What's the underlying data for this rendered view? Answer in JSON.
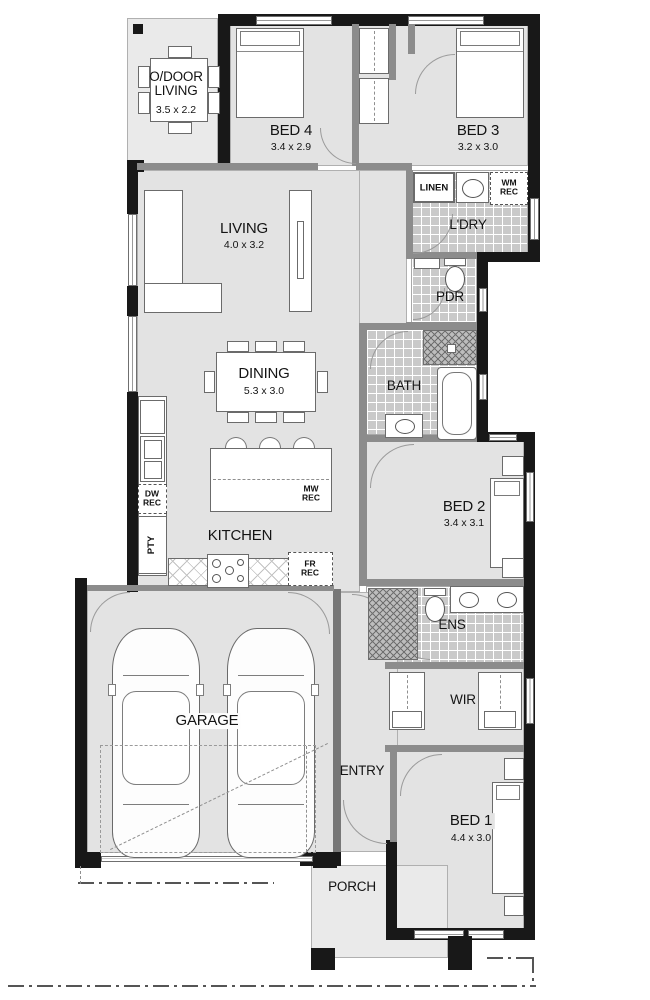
{
  "plan_title": "floor-plan",
  "colors": {
    "wall": "#181818",
    "floor": "#e3e3e3",
    "tile": "#c9c9c9",
    "ink": "#141414"
  },
  "rooms": {
    "odoor": {
      "line1": "O/DOOR",
      "line2": "LIVING",
      "dims": "3.5 x 2.2"
    },
    "bed4": {
      "name": "BED 4",
      "dims": "3.4 x 2.9"
    },
    "bed3": {
      "name": "BED 3",
      "dims": "3.2 x 3.0"
    },
    "linen": {
      "name": "LINEN"
    },
    "wm_rec": {
      "text": "WM\nREC"
    },
    "ldry": {
      "name": "L'DRY"
    },
    "pdr": {
      "name": "PDR"
    },
    "living": {
      "name": "LIVING",
      "dims": "4.0 x 3.2"
    },
    "dining": {
      "name": "DINING",
      "dims": "5.3 x 3.0"
    },
    "bath": {
      "name": "BATH"
    },
    "bed2": {
      "name": "BED 2",
      "dims": "3.4 x 3.1"
    },
    "kitchen": {
      "name": "KITCHEN"
    },
    "dw_rec": {
      "text": "DW\nREC"
    },
    "pty": {
      "name": "PTY"
    },
    "mw_rec": {
      "text": "MW\nREC"
    },
    "fr_rec": {
      "text": "FR\nREC"
    },
    "ens": {
      "name": "ENS"
    },
    "wir": {
      "name": "WIR"
    },
    "garage": {
      "name": "GARAGE"
    },
    "entry": {
      "name": "ENTRY"
    },
    "bed1": {
      "name": "BED 1",
      "dims": "4.4 x 3.0"
    },
    "porch": {
      "name": "PORCH"
    }
  }
}
